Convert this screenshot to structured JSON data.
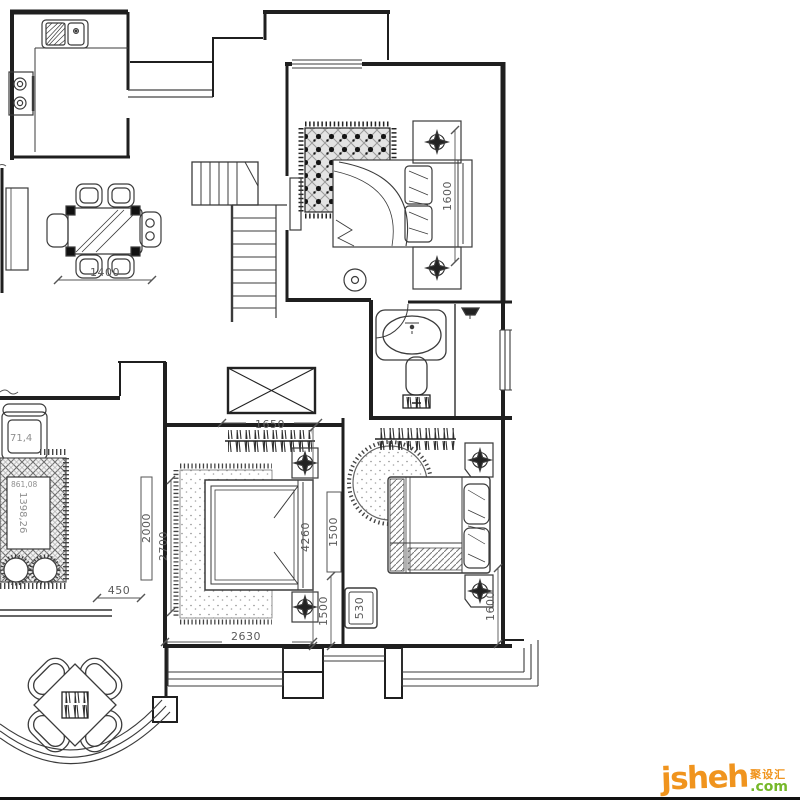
{
  "meta": {
    "title": "Residential CAD floor plan"
  },
  "colors": {
    "wall": "#1f1f1f",
    "furniture_line": "#3b3b3b",
    "dim_text": "#5a5a5a",
    "area_text": "#9a9a9a",
    "watermark_orange": "#f0941e",
    "watermark_green": "#76b82a",
    "background": "#ffffff"
  },
  "dimensions": {
    "dining_table_width": "1400",
    "bedroom_top_right_depth": "1600",
    "shaft_width": "1650",
    "living_edge": "2000",
    "bedroom_mid_left": "2700",
    "desk_offset": "450",
    "bedroom_mid_height": "4260",
    "closet_upper": "1500",
    "closet_lower": "1500",
    "bedside_stand": "530",
    "bedroom_right_side": "1600",
    "bedroom_mid_width": "2630"
  },
  "area_labels": {
    "armchair": "71,4",
    "coffee_table_vertical": "1398,26",
    "coffee_table_horizontal": "861,08"
  },
  "watermark": {
    "brand": "jsheh",
    "suffix": ".com",
    "chinese": "聚设汇"
  }
}
